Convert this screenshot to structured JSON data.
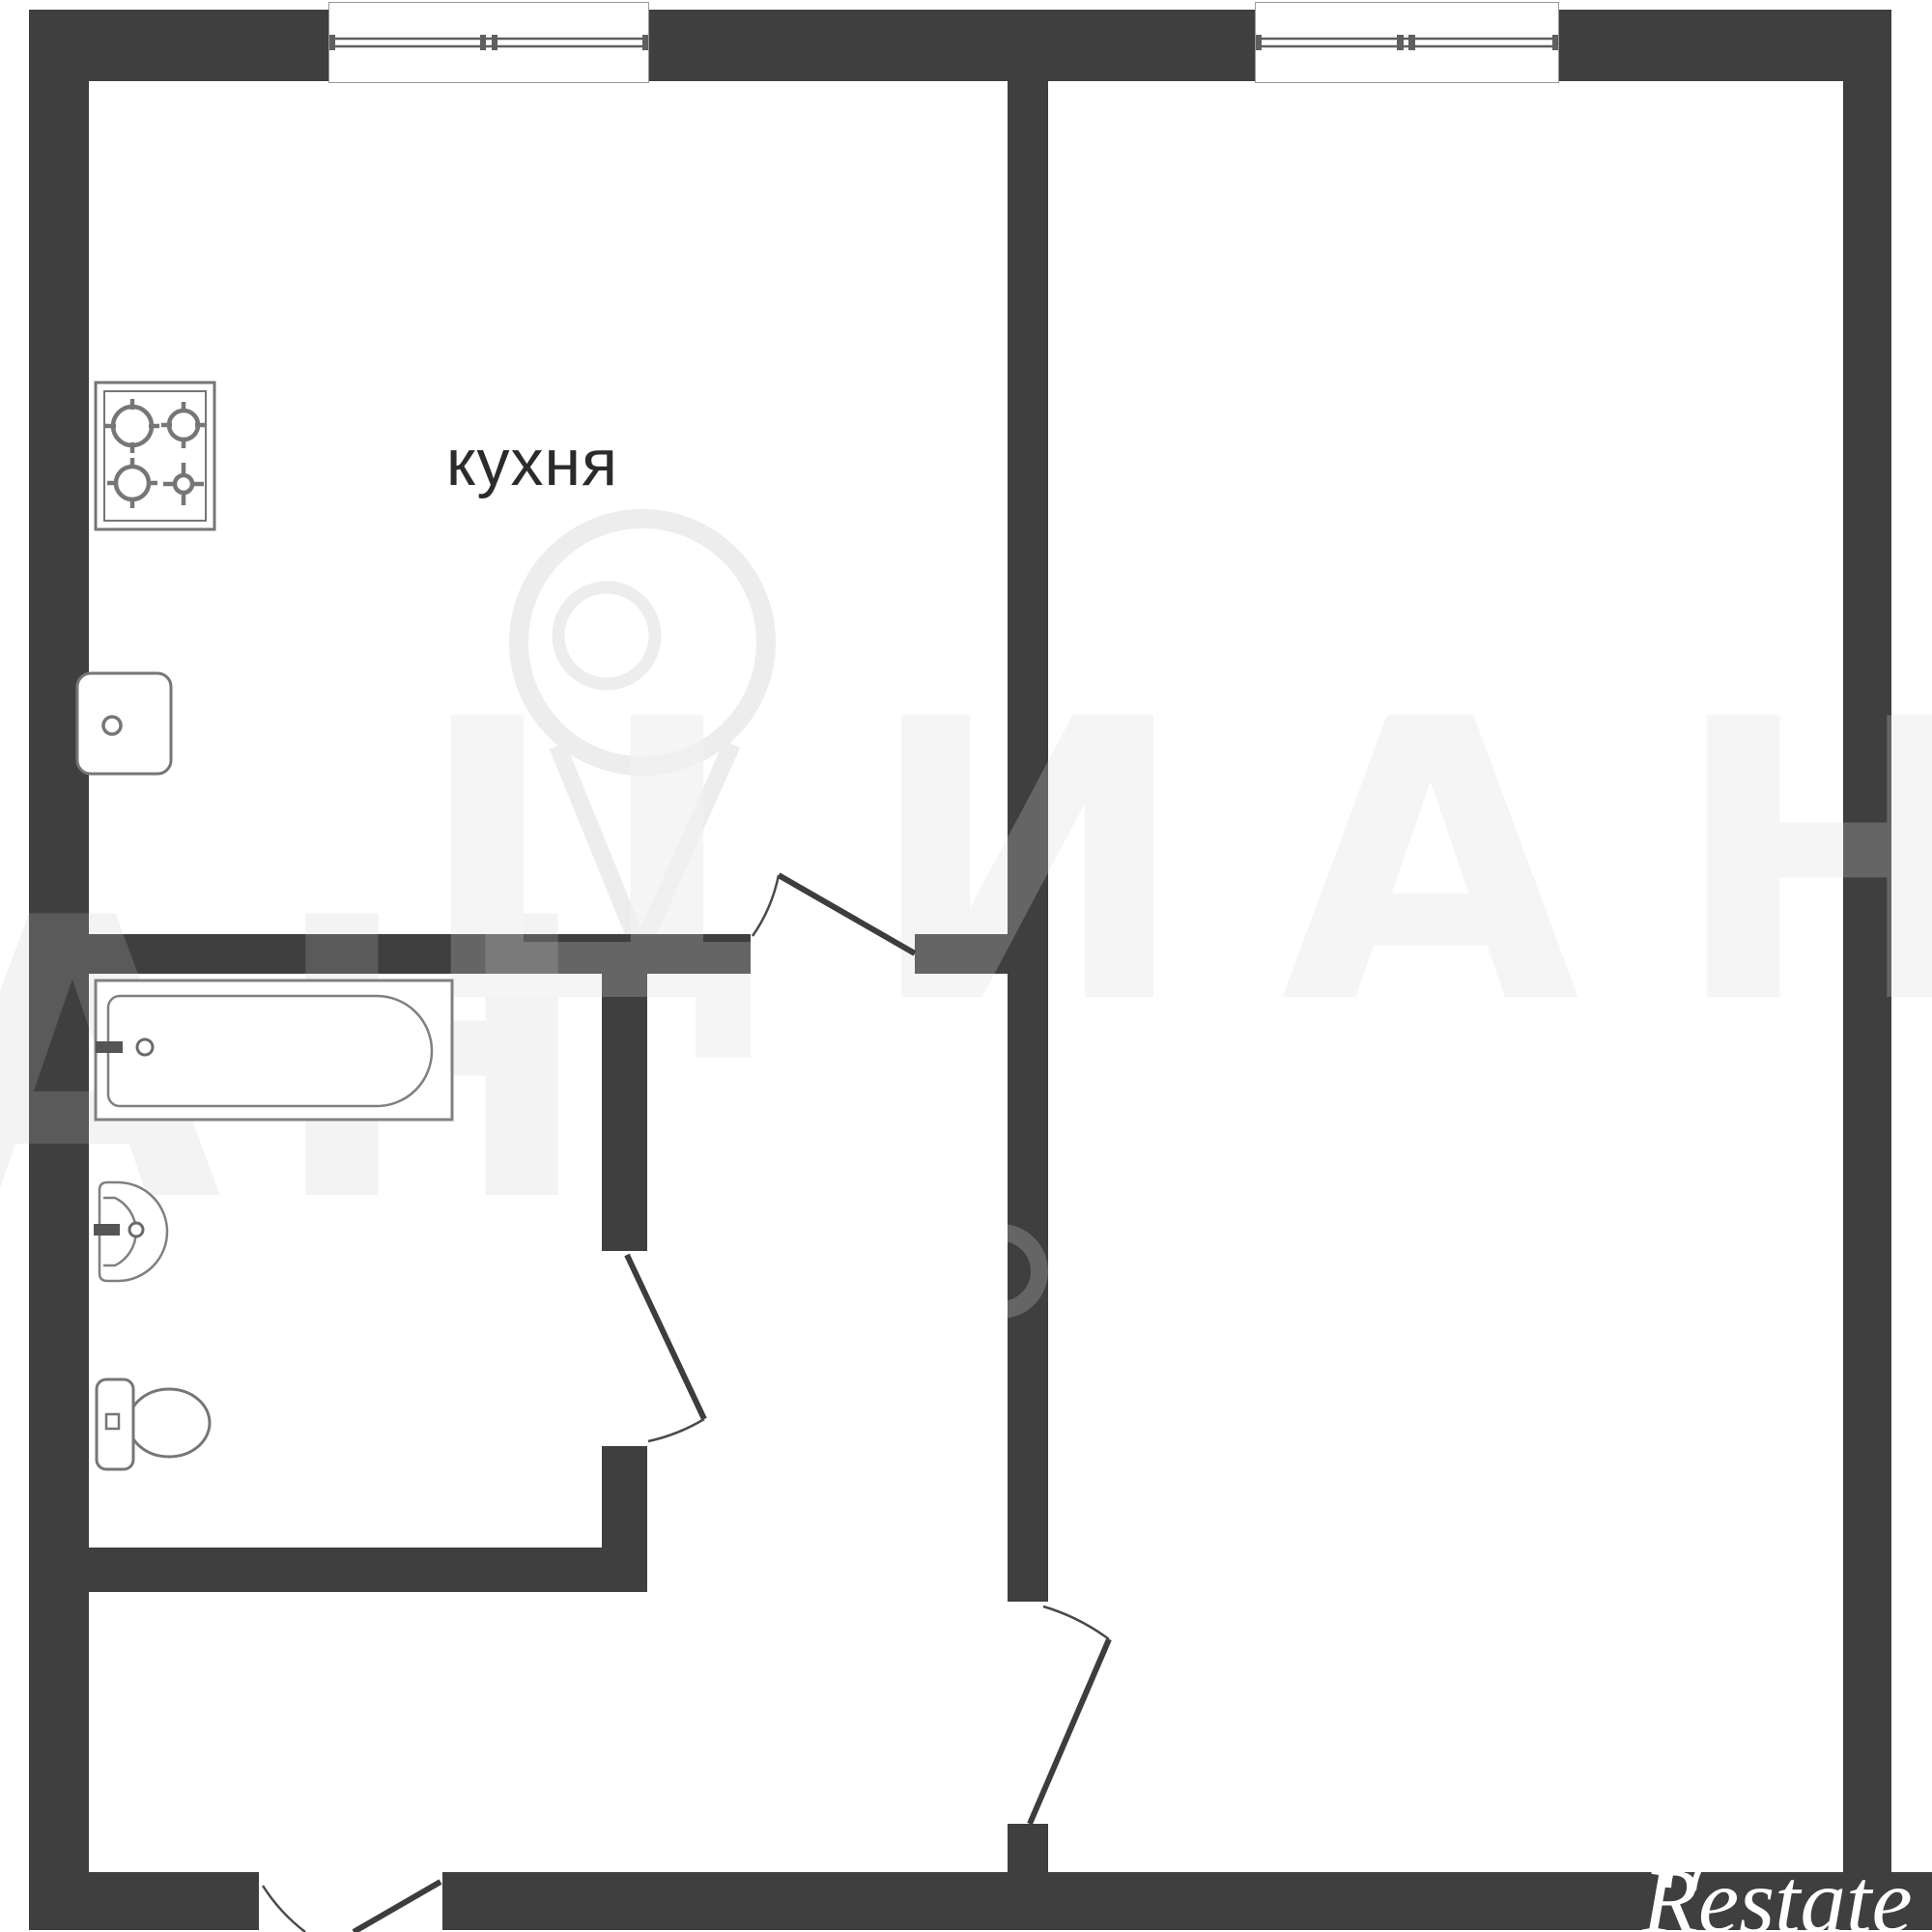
{
  "plan": {
    "room_label": "кухня",
    "watermark": {
      "row1": "ЦИАН",
      "row2": "АН"
    },
    "logo": {
      "text": "Restate"
    },
    "fixtures": [
      "stove",
      "sink",
      "bathtub",
      "washbasin",
      "toilet"
    ],
    "colors": {
      "wall": "#3f3f3f",
      "floor": "#ffffff",
      "fixture_line": "#7d7d7d",
      "door_line": "#3d3d3d",
      "watermark_tint_on_floor": "#f2f2f2",
      "logo_color": "#ffffff"
    }
  }
}
